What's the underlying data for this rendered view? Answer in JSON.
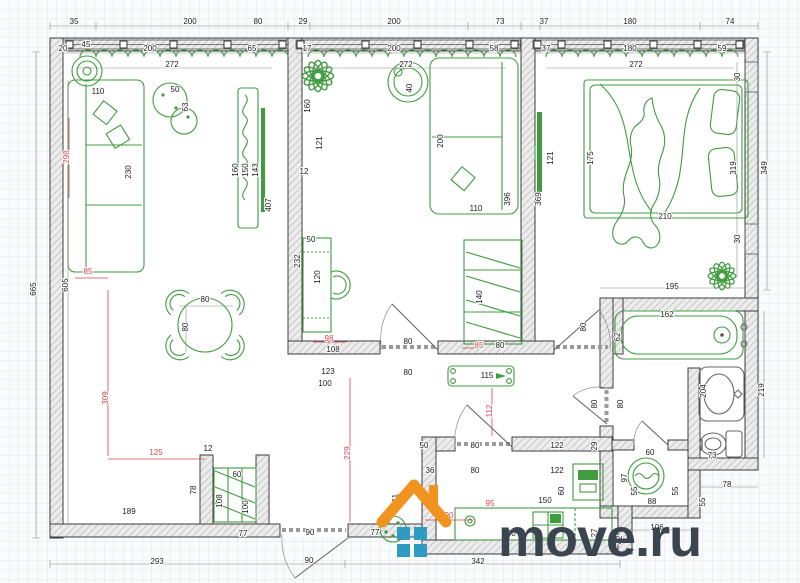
{
  "watermark": {
    "brand": "move.ru",
    "icon": "house-logo",
    "roof_color": "#f0941f",
    "window_color": "#2f9bc0",
    "text_color": "#3a4550"
  },
  "plan": {
    "colors": {
      "furn": "#3f9c3f",
      "wall_stroke": "#3c3c3c",
      "wall_fill": "#ececec",
      "hatch": "#b5b5b5",
      "dim_text": "#1c1c1c",
      "dim_red": "#d6454d",
      "grid": "#e3e5e9",
      "paper": "#fafbfc"
    },
    "dim_labels": [
      {
        "t": "35",
        "x": 74,
        "y": 24
      },
      {
        "t": "200",
        "x": 190,
        "y": 24
      },
      {
        "t": "80",
        "x": 258,
        "y": 24
      },
      {
        "t": "29",
        "x": 303,
        "y": 24
      },
      {
        "t": "200",
        "x": 394,
        "y": 24
      },
      {
        "t": "73",
        "x": 500,
        "y": 24
      },
      {
        "t": "37",
        "x": 544,
        "y": 24
      },
      {
        "t": "180",
        "x": 630,
        "y": 24
      },
      {
        "t": "74",
        "x": 730,
        "y": 24
      },
      {
        "t": "45",
        "x": 86,
        "y": 47
      },
      {
        "t": "20",
        "x": 63,
        "y": 51
      },
      {
        "t": "200",
        "x": 150,
        "y": 51
      },
      {
        "t": "65",
        "x": 252,
        "y": 51
      },
      {
        "t": "17",
        "x": 307,
        "y": 51
      },
      {
        "t": "200",
        "x": 394,
        "y": 51
      },
      {
        "t": "58",
        "x": 494,
        "y": 51
      },
      {
        "t": "37",
        "x": 546,
        "y": 51
      },
      {
        "t": "180",
        "x": 630,
        "y": 51
      },
      {
        "t": "59",
        "x": 722,
        "y": 51
      },
      {
        "t": "272",
        "x": 172,
        "y": 67
      },
      {
        "t": "272",
        "x": 406,
        "y": 67
      },
      {
        "t": "272",
        "x": 636,
        "y": 67
      },
      {
        "t": "110",
        "x": 98,
        "y": 94
      },
      {
        "t": "50",
        "x": 175,
        "y": 92
      },
      {
        "t": "63",
        "x": 188,
        "y": 107,
        "v": 1
      },
      {
        "t": "298",
        "x": 69,
        "y": 157,
        "v": 1,
        "r": 1
      },
      {
        "t": "230",
        "x": 131,
        "y": 172,
        "v": 1
      },
      {
        "t": "160",
        "x": 238,
        "y": 170,
        "v": 1
      },
      {
        "t": "150",
        "x": 248,
        "y": 170,
        "v": 1
      },
      {
        "t": "143",
        "x": 258,
        "y": 170,
        "v": 1
      },
      {
        "t": "407",
        "x": 271,
        "y": 205,
        "v": 1
      },
      {
        "t": "12",
        "x": 304,
        "y": 174
      },
      {
        "t": "605",
        "x": 68,
        "y": 285,
        "v": 1
      },
      {
        "t": "665",
        "x": 36,
        "y": 289,
        "v": 1
      },
      {
        "t": "85",
        "x": 88,
        "y": 274,
        "r": 1
      },
      {
        "t": "80",
        "x": 205,
        "y": 302
      },
      {
        "t": "80",
        "x": 188,
        "y": 327,
        "v": 1
      },
      {
        "t": "309",
        "x": 108,
        "y": 398,
        "v": 1,
        "r": 1
      },
      {
        "t": "125",
        "x": 156,
        "y": 455,
        "r": 1
      },
      {
        "t": "12",
        "x": 208,
        "y": 451
      },
      {
        "t": "78",
        "x": 196,
        "y": 490,
        "v": 1
      },
      {
        "t": "60",
        "x": 237,
        "y": 477
      },
      {
        "t": "108",
        "x": 222,
        "y": 501,
        "v": 1
      },
      {
        "t": "100",
        "x": 248,
        "y": 507,
        "v": 1
      },
      {
        "t": "77",
        "x": 243,
        "y": 536
      },
      {
        "t": "189",
        "x": 129,
        "y": 514
      },
      {
        "t": "293",
        "x": 157,
        "y": 564
      },
      {
        "t": "160",
        "x": 310,
        "y": 106,
        "v": 1
      },
      {
        "t": "121",
        "x": 322,
        "y": 143,
        "v": 1
      },
      {
        "t": "40",
        "x": 412,
        "y": 88,
        "v": 1
      },
      {
        "t": "200",
        "x": 443,
        "y": 141,
        "v": 1
      },
      {
        "t": "110",
        "x": 476,
        "y": 211
      },
      {
        "t": "396",
        "x": 510,
        "y": 199,
        "v": 1
      },
      {
        "t": "50",
        "x": 311,
        "y": 242
      },
      {
        "t": "232",
        "x": 300,
        "y": 261,
        "v": 1
      },
      {
        "t": "120",
        "x": 320,
        "y": 277,
        "v": 1
      },
      {
        "t": "140",
        "x": 482,
        "y": 297,
        "v": 1
      },
      {
        "t": "85",
        "x": 479,
        "y": 348,
        "r": 1
      },
      {
        "t": "80",
        "x": 500,
        "y": 348
      },
      {
        "t": "98",
        "x": 329,
        "y": 341,
        "r": 1
      },
      {
        "t": "108",
        "x": 333,
        "y": 352
      },
      {
        "t": "80",
        "x": 408,
        "y": 344
      },
      {
        "t": "123",
        "x": 328,
        "y": 374
      },
      {
        "t": "100",
        "x": 325,
        "y": 386
      },
      {
        "t": "80",
        "x": 408,
        "y": 375
      },
      {
        "t": "115",
        "x": 487,
        "y": 378
      },
      {
        "t": "121",
        "x": 553,
        "y": 158,
        "v": 1
      },
      {
        "t": "175",
        "x": 593,
        "y": 158,
        "v": 1
      },
      {
        "t": "210",
        "x": 665,
        "y": 219
      },
      {
        "t": "30",
        "x": 740,
        "y": 77,
        "v": 1
      },
      {
        "t": "30",
        "x": 740,
        "y": 239,
        "v": 1
      },
      {
        "t": "369",
        "x": 541,
        "y": 199,
        "v": 1
      },
      {
        "t": "319",
        "x": 736,
        "y": 168,
        "v": 1
      },
      {
        "t": "349",
        "x": 767,
        "y": 168,
        "v": 1
      },
      {
        "t": "195",
        "x": 672,
        "y": 289
      },
      {
        "t": "80",
        "x": 586,
        "y": 327,
        "v": 1
      },
      {
        "t": "80",
        "x": 597,
        "y": 404,
        "v": 1
      },
      {
        "t": "80",
        "x": 623,
        "y": 404,
        "v": 1
      },
      {
        "t": "229",
        "x": 350,
        "y": 453,
        "v": 1,
        "r": 1
      },
      {
        "t": "112",
        "x": 492,
        "y": 411,
        "v": 1,
        "r": 1
      },
      {
        "t": "90",
        "x": 310,
        "y": 535
      },
      {
        "t": "77",
        "x": 375,
        "y": 535
      },
      {
        "t": "90",
        "x": 309,
        "y": 563
      },
      {
        "t": "111",
        "x": 398,
        "y": 500,
        "v": 1
      },
      {
        "t": "342",
        "x": 478,
        "y": 564
      },
      {
        "t": "50",
        "x": 424,
        "y": 448
      },
      {
        "t": "80",
        "x": 475,
        "y": 448
      },
      {
        "t": "122",
        "x": 557,
        "y": 448
      },
      {
        "t": "29",
        "x": 597,
        "y": 446,
        "v": 1
      },
      {
        "t": "36",
        "x": 430,
        "y": 473
      },
      {
        "t": "80",
        "x": 475,
        "y": 473
      },
      {
        "t": "122",
        "x": 557,
        "y": 473
      },
      {
        "t": "60",
        "x": 564,
        "y": 491,
        "v": 1
      },
      {
        "t": "150",
        "x": 545,
        "y": 503
      },
      {
        "t": "95",
        "x": 490,
        "y": 506,
        "r": 1
      },
      {
        "t": "90",
        "x": 449,
        "y": 518,
        "r": 1
      },
      {
        "t": "240",
        "x": 509,
        "y": 536
      },
      {
        "t": "27",
        "x": 597,
        "y": 533,
        "v": 1
      },
      {
        "t": "42",
        "x": 622,
        "y": 540,
        "v": 1
      },
      {
        "t": "60",
        "x": 650,
        "y": 455
      },
      {
        "t": "97",
        "x": 627,
        "y": 478,
        "v": 1
      },
      {
        "t": "55",
        "x": 637,
        "y": 491,
        "v": 1
      },
      {
        "t": "88",
        "x": 652,
        "y": 504
      },
      {
        "t": "55",
        "x": 678,
        "y": 491,
        "v": 1
      },
      {
        "t": "162",
        "x": 667,
        "y": 317
      },
      {
        "t": "62",
        "x": 620,
        "y": 337,
        "v": 1
      },
      {
        "t": "204",
        "x": 706,
        "y": 391,
        "v": 1
      },
      {
        "t": "73",
        "x": 712,
        "y": 458
      },
      {
        "t": "219",
        "x": 764,
        "y": 390,
        "v": 1
      },
      {
        "t": "78",
        "x": 727,
        "y": 487
      },
      {
        "t": "55",
        "x": 705,
        "y": 502,
        "v": 1
      },
      {
        "t": "106",
        "x": 657,
        "y": 530
      }
    ]
  }
}
